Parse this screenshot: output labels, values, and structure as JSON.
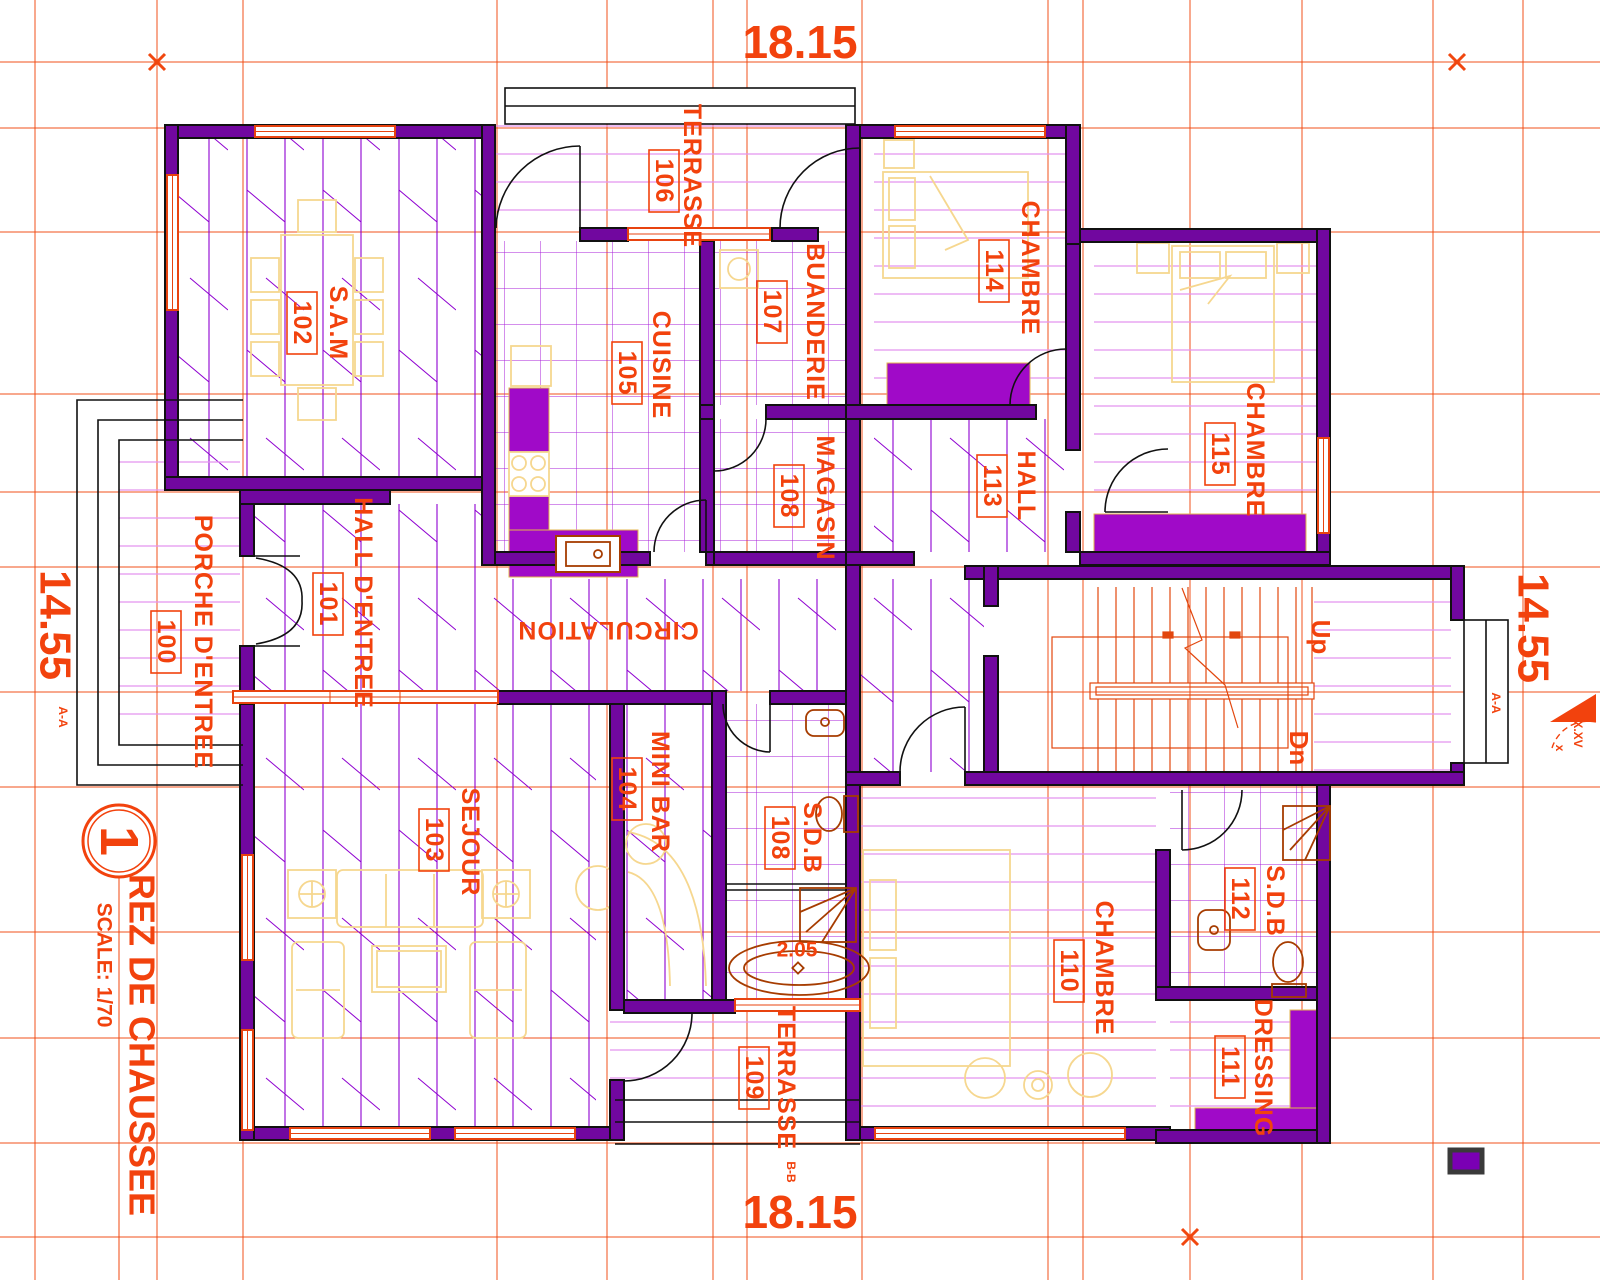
{
  "title_block": {
    "sheet_number": "1",
    "title": "REZ DE CHAUSSEE",
    "scale": "SCALE: 1/70"
  },
  "dimensions": {
    "top": "18.15",
    "bottom": "18.15",
    "left": "14.55",
    "right": "14.55"
  },
  "section_marks": {
    "left": "A-A",
    "right": "A-A",
    "bottom": "B-B",
    "symbol_text": "X.XV",
    "symbol_sub": "x"
  },
  "stairs": {
    "up_label": "Up",
    "down_label": "Dn"
  },
  "fixtures": {
    "bathtub_width": "2.05"
  },
  "rooms": [
    {
      "name": "PORCHE D'ENTREE",
      "number": "100"
    },
    {
      "name": "HALL D'ENTREE",
      "number": "101"
    },
    {
      "name": "S.A.M",
      "number": "102"
    },
    {
      "name": "SEJOUR",
      "number": "103"
    },
    {
      "name": "MINI BAR",
      "number": "104"
    },
    {
      "name": "CUISINE",
      "number": "105"
    },
    {
      "name": "TERRASSE",
      "number": "106"
    },
    {
      "name": "BUANDERIE",
      "number": "107"
    },
    {
      "name": "MAGASIN",
      "number": "108"
    },
    {
      "name": "S.D.B",
      "number": "108"
    },
    {
      "name": "TERRASSE",
      "number": "109"
    },
    {
      "name": "CHAMBRE",
      "number": "110"
    },
    {
      "name": "DRESSING",
      "number": "111"
    },
    {
      "name": "S.D.B",
      "number": "112"
    },
    {
      "name": "HALL",
      "number": "113"
    },
    {
      "name": "CHAMBRE",
      "number": "114"
    },
    {
      "name": "CHAMBRE",
      "number": "115"
    },
    {
      "name": "CIRCULATION",
      "number": ""
    }
  ],
  "colors": {
    "label_orange": "#F2420D",
    "grid_orange": "#F1470F",
    "wall_purple": "#71079F",
    "cabinet_purple": "#A00AC8",
    "hatch_light": "#E393EF",
    "hatch_dark": "#8E00D0",
    "tile_purple": "#A81FD8",
    "furniture_yellow": "#F6D78F",
    "fixture_brown": "#A63C00"
  }
}
